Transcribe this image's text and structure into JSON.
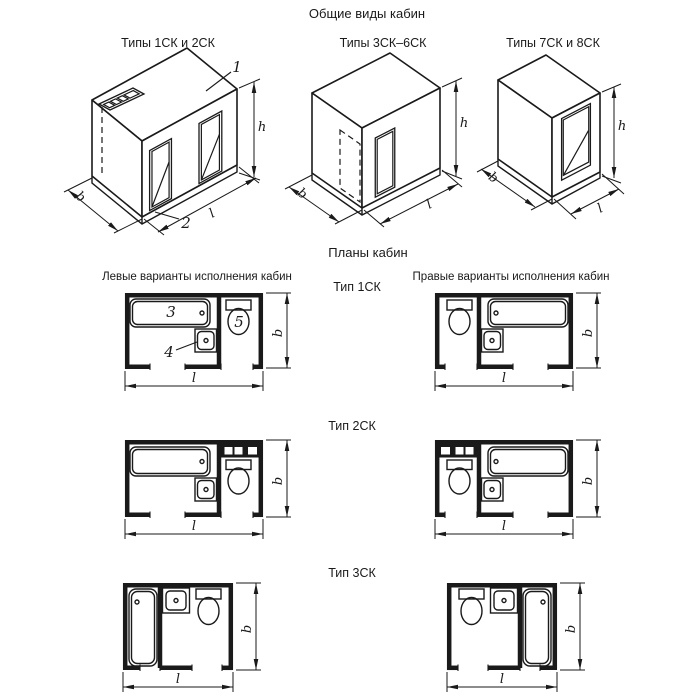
{
  "titles": {
    "main": "Общие виды кабин",
    "plans": "Планы кабин",
    "left_variants": "Левые варианты исполнения кабин",
    "right_variants": "Правые варианты исполнения кабин"
  },
  "view_labels": {
    "view1": "Типы 1СК и 2СК",
    "view2": "Типы 3СК–6СК",
    "view3": "Типы 7СК и 8СК"
  },
  "type_labels": {
    "row1": "Тип 1СК",
    "row2": "Тип 2СК",
    "row3": "Тип 3СК"
  },
  "dims": {
    "b": "b",
    "l": "l",
    "h": "h"
  },
  "callouts": {
    "c1": "1",
    "c2": "2",
    "c3": "3",
    "c4": "4",
    "c5": "5"
  },
  "colors": {
    "line": "#1a1a1a",
    "background": "#ffffff"
  }
}
